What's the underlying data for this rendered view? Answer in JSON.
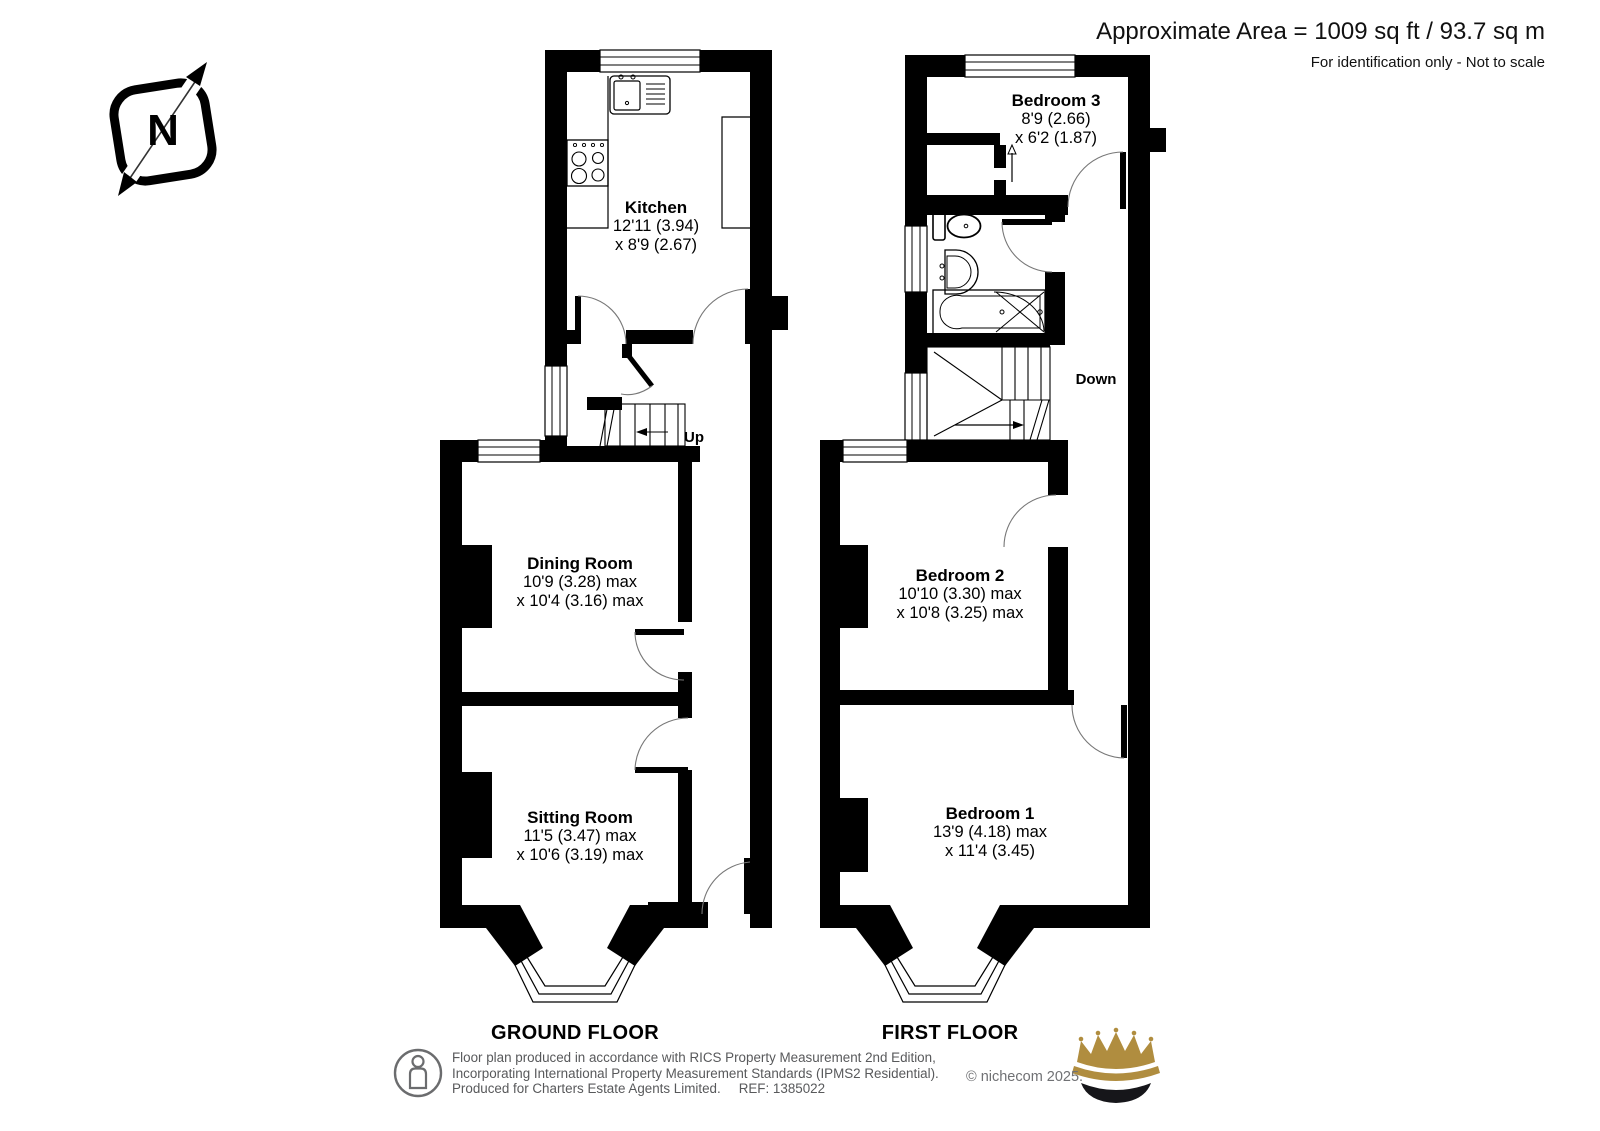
{
  "header": {
    "area_text": "Approximate Area = 1009 sq ft / 93.7 sq m",
    "note_text": "For identification only - Not to scale"
  },
  "compass": {
    "north_letter": "N"
  },
  "floors": [
    {
      "caption": "GROUND FLOOR",
      "stair_label": "Up",
      "rooms": [
        {
          "name": "Kitchen",
          "dim1": "12'11 (3.94)",
          "dim2": "x 8'9 (2.67)"
        },
        {
          "name": "Dining Room",
          "dim1": "10'9 (3.28) max",
          "dim2": "x 10'4 (3.16) max"
        },
        {
          "name": "Sitting Room",
          "dim1": "11'5 (3.47) max",
          "dim2": "x 10'6 (3.19) max"
        }
      ]
    },
    {
      "caption": "FIRST FLOOR",
      "stair_label": "Down",
      "rooms": [
        {
          "name": "Bedroom 3",
          "dim1": "8'9 (2.66)",
          "dim2": "x 6'2 (1.87)"
        },
        {
          "name": "Bedroom 2",
          "dim1": "10'10 (3.30) max",
          "dim2": "x 10'8 (3.25) max"
        },
        {
          "name": "Bedroom 1",
          "dim1": "13'9 (4.18) max",
          "dim2": "x 11'4 (3.45)"
        }
      ]
    }
  ],
  "footer": {
    "line1": "Floor plan produced in accordance with RICS Property Measurement 2nd Edition,",
    "line2": "Incorporating International Property Measurement Standards (IPMS2 Residential).",
    "line3": "Produced for Charters Estate Agents Limited.",
    "ref": "REF: 1385022",
    "copyright": "© nichecom 2025."
  },
  "colors": {
    "wall": "#000000",
    "footer_text": "#58595b",
    "crown_gold": "#b08d3f"
  },
  "icons": {
    "compass": "north-compass-icon",
    "footer_badge": "person-oval-icon",
    "brand": "crown-logo"
  }
}
